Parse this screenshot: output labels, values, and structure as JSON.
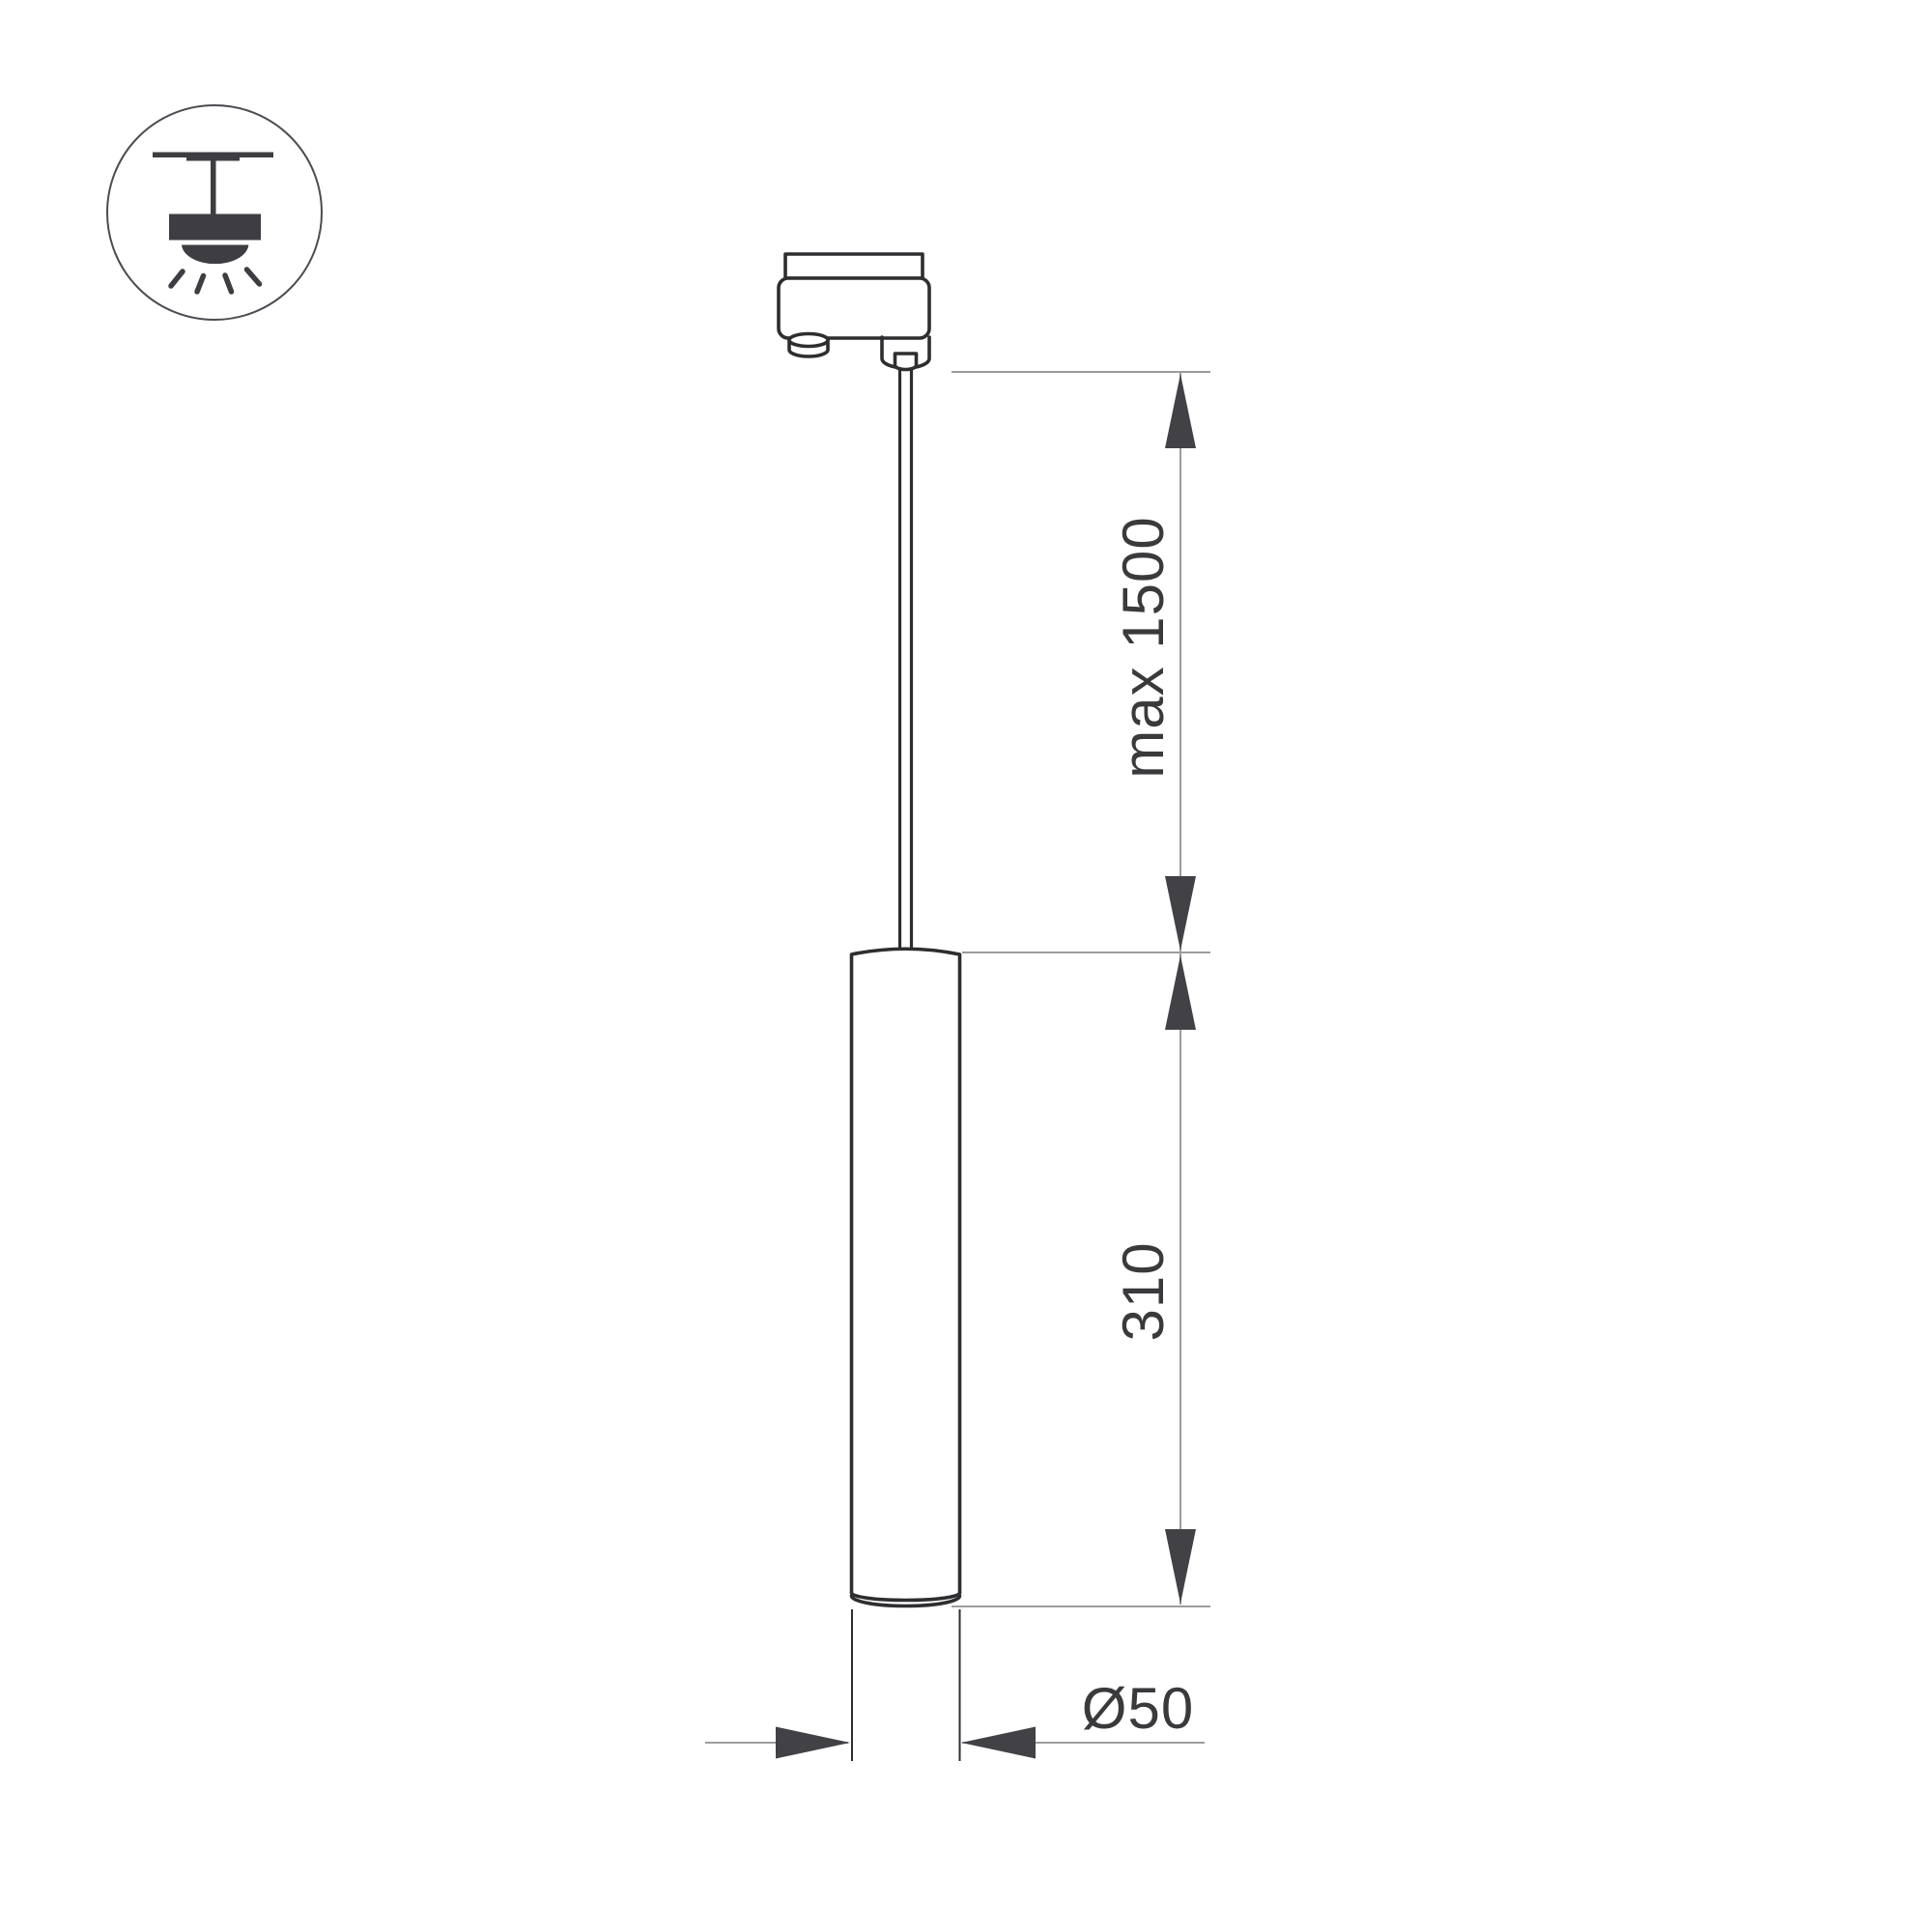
{
  "drawing": {
    "kind": "pendant-luminaire-dimension-drawing",
    "background": "#ffffff",
    "labels": {
      "suspension_length": "max 1500",
      "body_height": "310",
      "body_diameter": "Ø50"
    },
    "icon": {
      "name": "track-mounted-pendant-symbol"
    },
    "colors": {
      "bg": "#ffffff",
      "ink": "#2e2e31",
      "icon": "#3d3d42",
      "circle": "#4c4c52",
      "dim": "#9c9c9c",
      "arrow": "#414146",
      "text": "#3a3a3d"
    }
  }
}
